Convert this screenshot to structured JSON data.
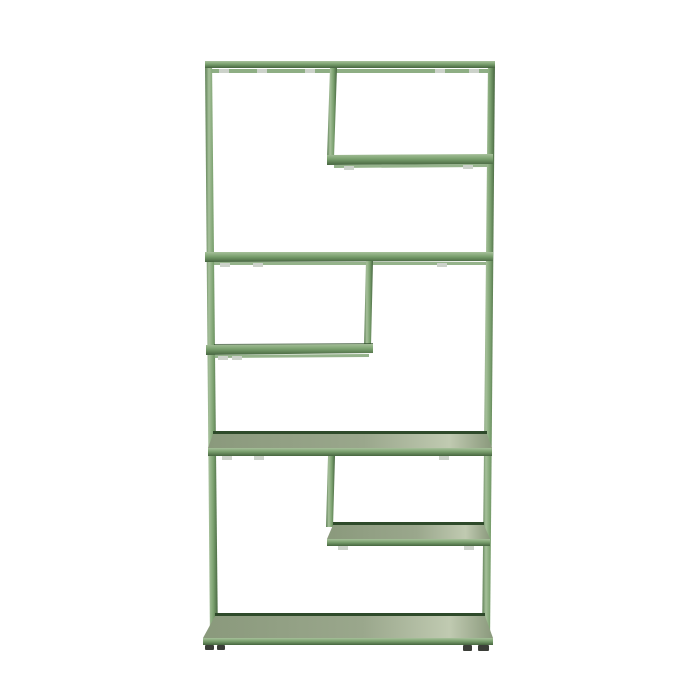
{
  "page": {
    "background": "#ffffff",
    "description": "Green metal open shelving unit with six staggered shelves and offset vertical dividers, photographed on a plain white background"
  },
  "colors": {
    "background": "#ffffff",
    "frame": "#7aa06e",
    "frame_light": "#a6c09a",
    "frame_dark": "#5b7d53",
    "frame_darker": "#46653f",
    "surface": "#8a997c",
    "surface_light": "#9aa78c",
    "sheen": "#c0cab1",
    "metal": "#ccd2ca",
    "shadow_line": "#2e4a2a",
    "feet": "#3b3e38"
  },
  "furniture": {
    "type": "shelving-unit",
    "frame_color_name": "green",
    "shelf_count": 6,
    "divider_count": 3
  }
}
